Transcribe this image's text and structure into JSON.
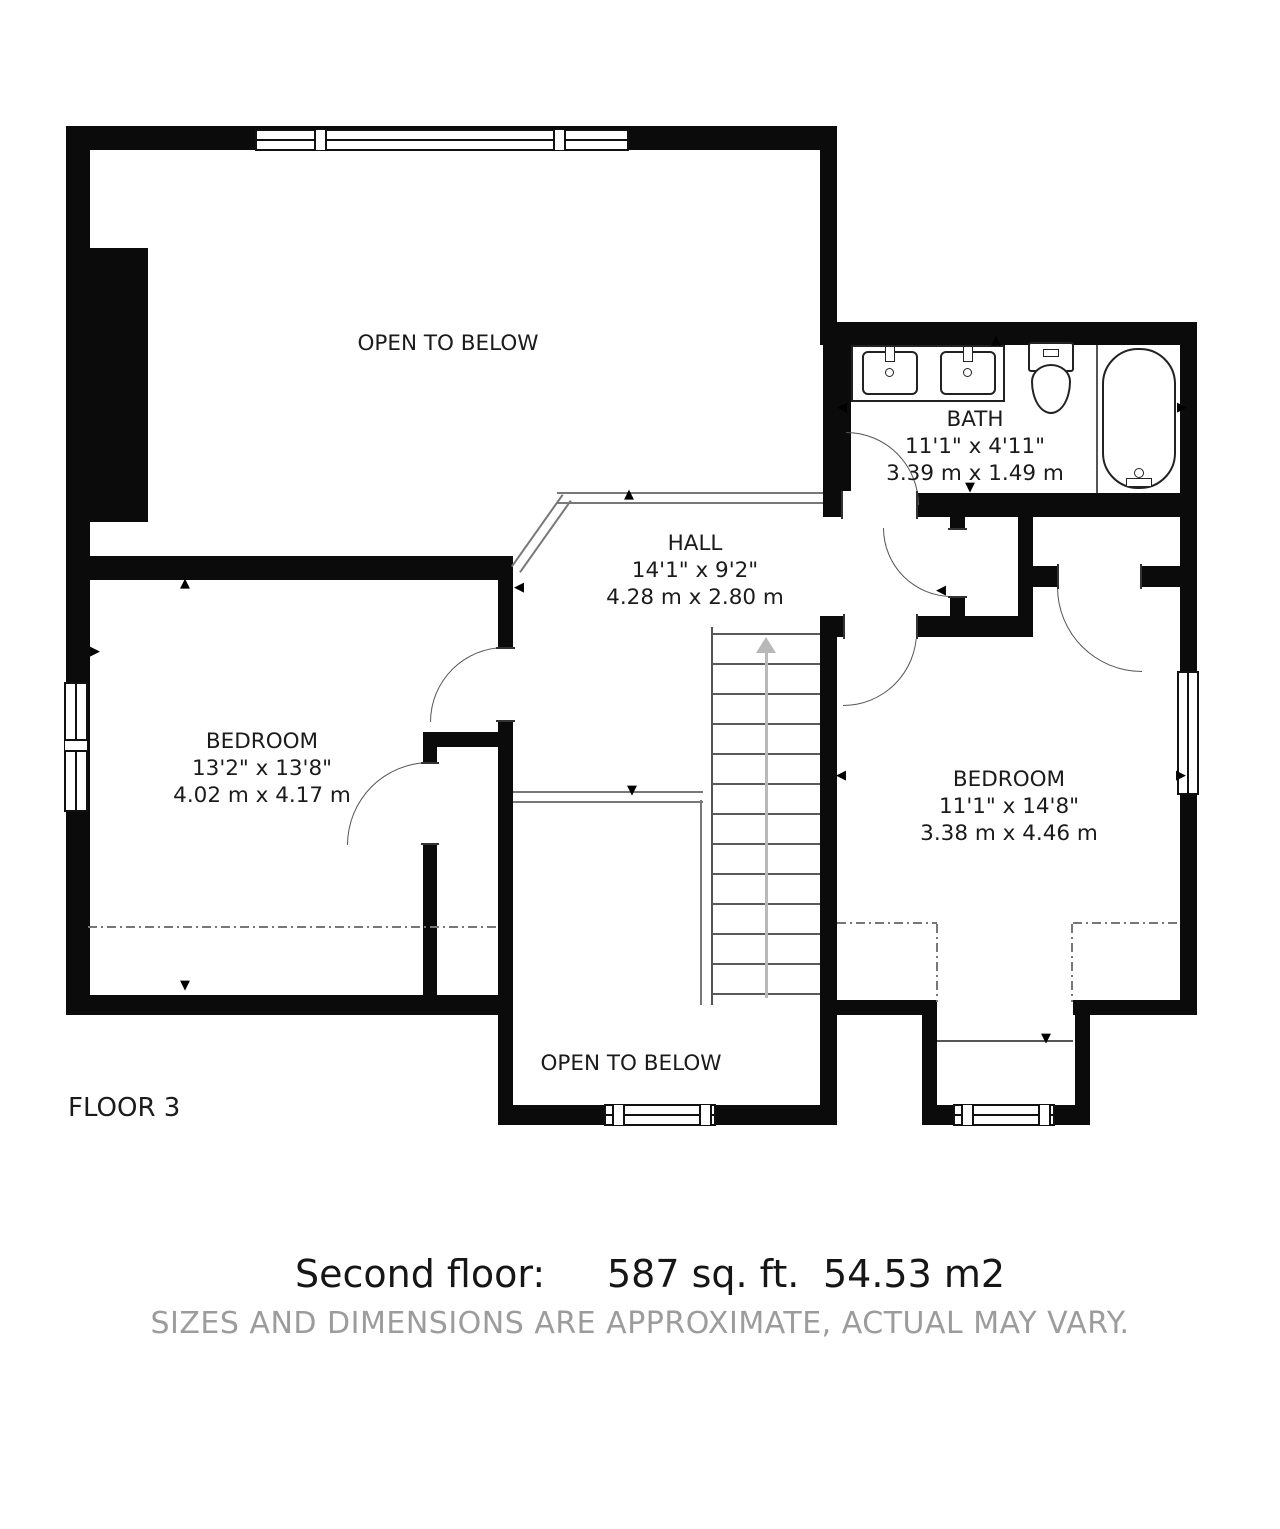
{
  "floor_label": "FLOOR 3",
  "rooms": {
    "open_to_below_top": {
      "label": "OPEN TO BELOW"
    },
    "bath": {
      "label": "BATH",
      "size_imperial": "11'1\" x 4'11\"",
      "size_metric": "3.39 m x 1.49 m"
    },
    "hall": {
      "label": "HALL",
      "size_imperial": "14'1\" x 9'2\"",
      "size_metric": "4.28 m x 2.80 m"
    },
    "bedroom_left": {
      "label": "BEDROOM",
      "size_imperial": "13'2\" x 13'8\"",
      "size_metric": "4.02 m x 4.17 m"
    },
    "bedroom_right": {
      "label": "BEDROOM",
      "size_imperial": "11'1\" x 14'8\"",
      "size_metric": "3.38 m x 4.46 m"
    },
    "open_to_below_bottom": {
      "label": "OPEN TO BELOW"
    }
  },
  "footer": {
    "floor_name": "Second floor:",
    "area_imperial": "587 sq. ft.",
    "area_metric": "54.53 m2",
    "disclaimer": "SIZES AND DIMENSIONS ARE APPROXIMATE, ACTUAL MAY VARY."
  },
  "icons": {
    "up": "▲",
    "down": "▼",
    "left": "◀",
    "right": "▶"
  }
}
